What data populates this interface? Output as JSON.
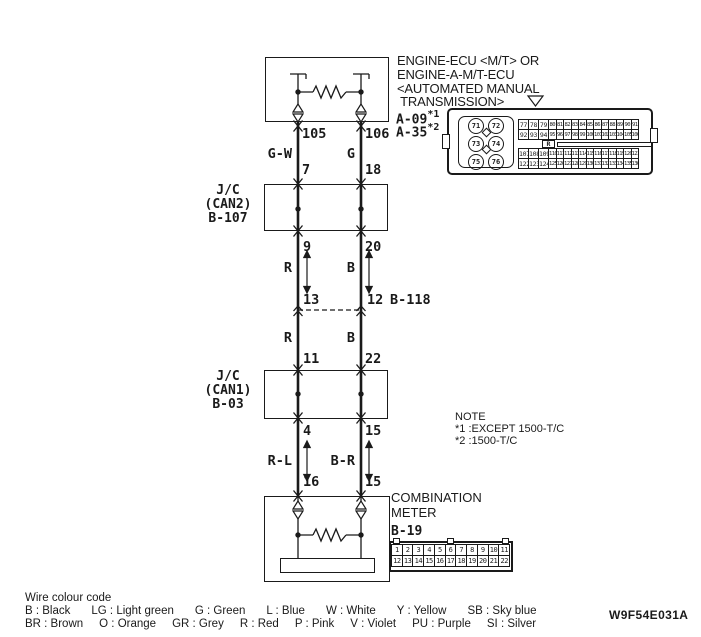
{
  "doc_code": "W9F54E031A",
  "ecu": {
    "title_lines": [
      "ENGINE-ECU <M/T> OR",
      "ENGINE-A-M/T-ECU",
      "<AUTOMATED MANUAL",
      " TRANSMISSION>"
    ],
    "refs": [
      {
        "id": "A-09",
        "note": "*1"
      },
      {
        "id": "A-35",
        "note": "*2"
      }
    ]
  },
  "connector_a": {
    "circles": [
      "71",
      "72",
      "73",
      "74",
      "75",
      "76"
    ],
    "marker": "R",
    "rows": [
      [
        "77",
        "78",
        "79",
        "80",
        "81",
        "82",
        "83",
        "84",
        "85",
        "86",
        "87",
        "88",
        "89",
        "90",
        "91"
      ],
      [
        "92",
        "93",
        "94",
        "95",
        "96",
        "97",
        "98",
        "99",
        "100",
        "101",
        "102",
        "103",
        "104",
        "105",
        "106"
      ],
      [
        "107",
        "108",
        "109",
        "110",
        "111",
        "112",
        "113",
        "114",
        "115",
        "116",
        "117",
        "118",
        "119",
        "120",
        "121"
      ],
      [
        "122",
        "123",
        "124",
        "125",
        "126",
        "127",
        "128",
        "129",
        "130",
        "131",
        "132",
        "133",
        "134",
        "135",
        "136"
      ]
    ]
  },
  "jc2": {
    "lines": [
      "J/C",
      "(CAN2)",
      "B-107"
    ]
  },
  "jc1": {
    "lines": [
      "J/C",
      "(CAN1)",
      "B-03"
    ]
  },
  "b118": {
    "label": "B-118"
  },
  "meter": {
    "name_lines": [
      "COMBINATION",
      "METER"
    ],
    "ref": "B-19"
  },
  "connector_b19": {
    "rows": [
      [
        "1",
        "2",
        "3",
        "4",
        "5",
        "6",
        "7",
        "8",
        "9",
        "10",
        "11"
      ],
      [
        "12",
        "13",
        "14",
        "15",
        "16",
        "17",
        "18",
        "19",
        "20",
        "21",
        "22"
      ]
    ]
  },
  "pins": {
    "ecu_left": "105",
    "ecu_right": "106",
    "jc2_in_left": "7",
    "jc2_in_right": "18",
    "jc2_out_left": "9",
    "jc2_out_right": "20",
    "b118_left": "13",
    "b118_right": "12",
    "jc1_in_left": "11",
    "jc1_in_right": "22",
    "jc1_out_left": "4",
    "jc1_out_right": "15",
    "meter_left": "16",
    "meter_right": "15"
  },
  "wire_colors": {
    "ecu_left": "G-W",
    "ecu_right": "G",
    "mid_upper_left": "R",
    "mid_upper_right": "B",
    "mid_lower_left": "R",
    "mid_lower_right": "B",
    "meter_left": "R-L",
    "meter_right": "B-R"
  },
  "note": {
    "title": "NOTE",
    "lines": [
      "*1 :EXCEPT 1500-T/C",
      "*2 :1500-T/C"
    ]
  },
  "legend": {
    "title": "Wire colour code",
    "row1": [
      "B : Black",
      "LG : Light green",
      "G : Green",
      "L : Blue",
      "W : White",
      "Y : Yellow",
      "SB : Sky blue"
    ],
    "row2": [
      "BR : Brown",
      "O : Orange",
      "GR : Grey",
      "R : Red",
      "P : Pink",
      "V : Violet",
      "PU : Purple",
      "SI : Silver"
    ]
  }
}
